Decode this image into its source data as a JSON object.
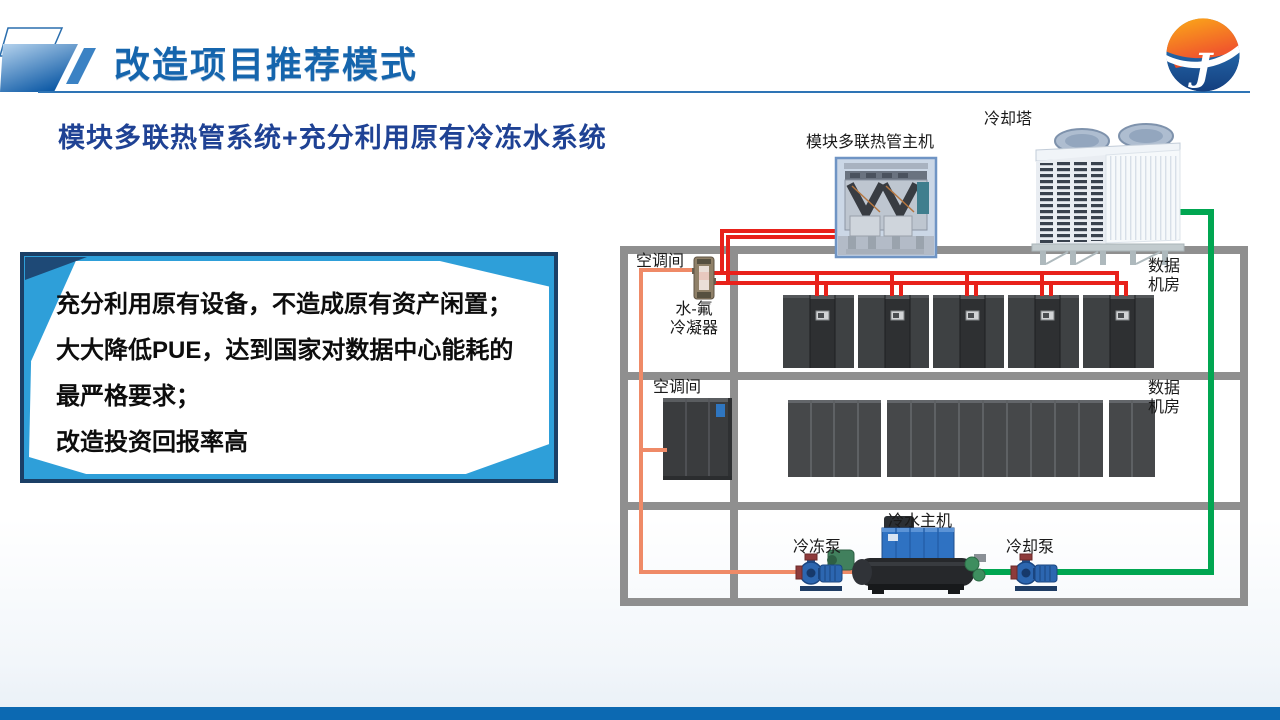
{
  "slide": {
    "title": "改造项目推荐模式",
    "subtitle": "模块多联热管系统+充分利用原有冷冻水系统",
    "highlight_box": {
      "lines": [
        "充分利用原有设备，不造成原有资产闲置；",
        "大大降低PUE，达到国家对数据中心能耗的",
        "最严格要求；",
        "改造投资回报率高"
      ]
    },
    "diagram": {
      "labels": {
        "heat_pipe_unit": "模块多联热管主机",
        "cooling_tower": "冷却塔",
        "ac_room_1": "空调间",
        "condenser": "水-氟\n冷凝器",
        "data_room_1": "数据\n机房",
        "ac_room_2": "空调间",
        "data_room_2": "数据\n机房",
        "chiller": "冷水主机",
        "chilled_pump": "冷冻泵",
        "cooling_pump": "冷却泵"
      }
    },
    "logo": {
      "glyph": "J"
    },
    "colors": {
      "title_blue": "#1565ad",
      "subtitle_navy": "#1f4294",
      "box_cyan": "#2e9fd9",
      "box_navy": "#1b3f66",
      "pipe_red": "#e8211a",
      "pipe_orange": "#ef8a67",
      "pipe_green": "#00a651",
      "wall_gray": "#8f8f8f",
      "footer_blue": "#0c69b2",
      "logo_orange": "#f7a21b",
      "logo_blue": "#1b5ea8"
    }
  }
}
